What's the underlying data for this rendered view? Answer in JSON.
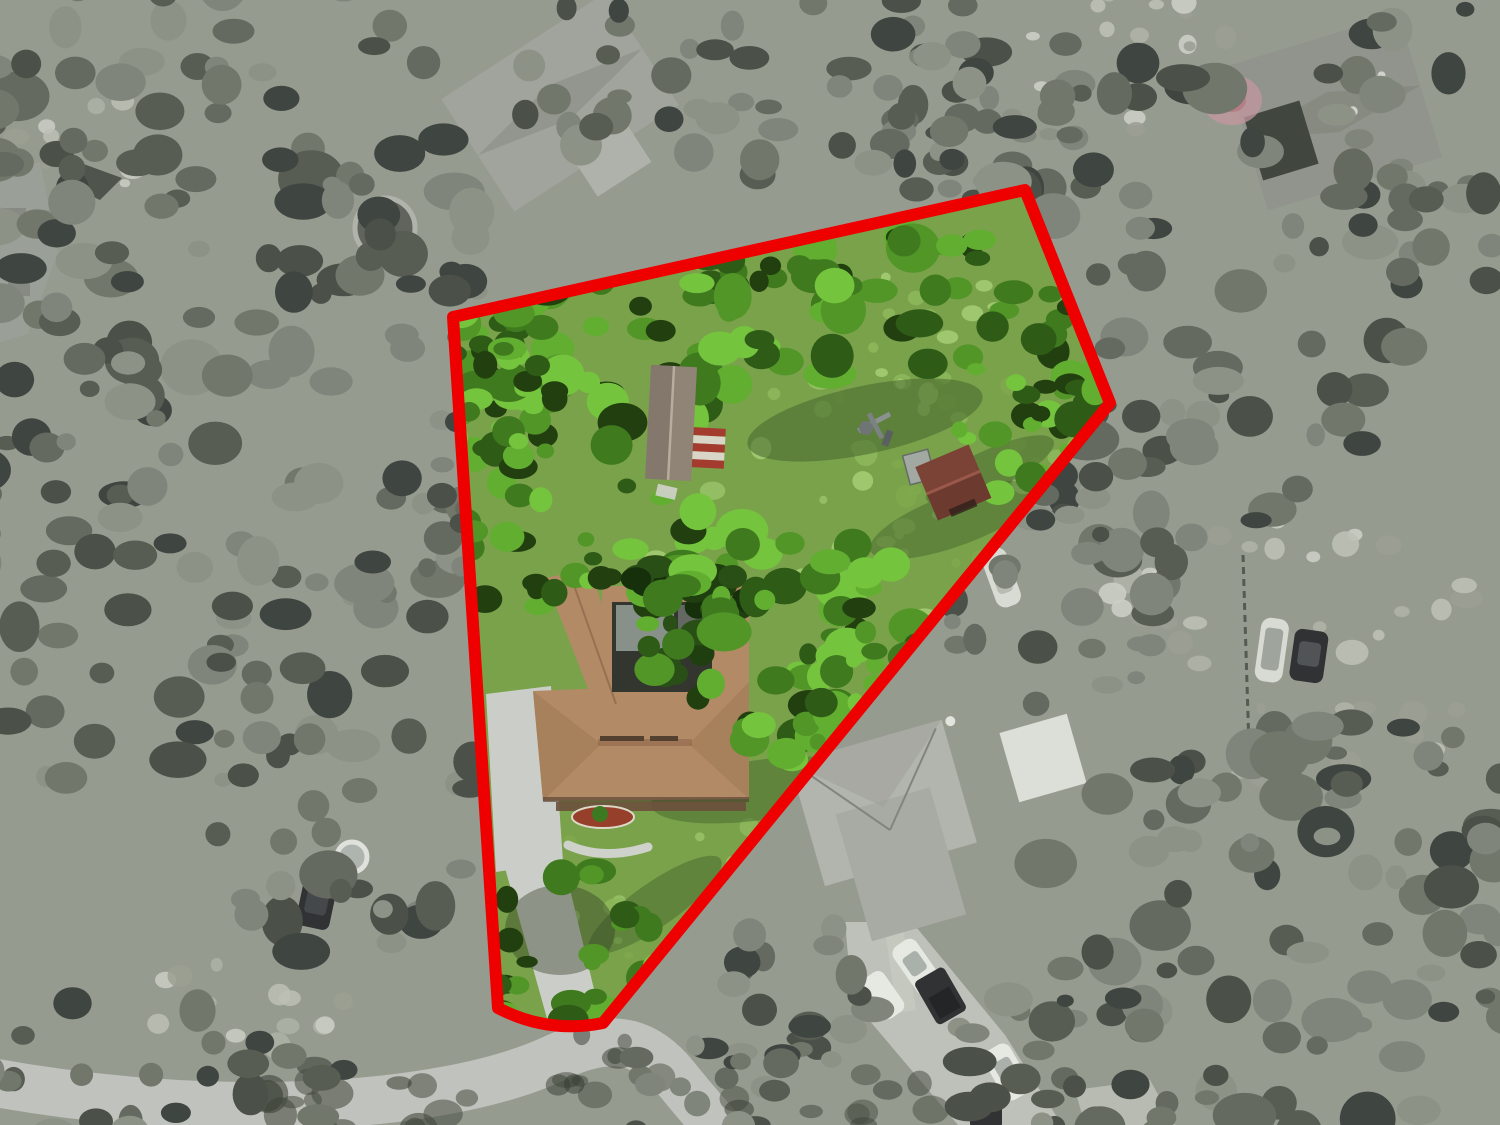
{
  "scene": {
    "type": "aerial-drone-photo",
    "subject": "residential property with red parcel boundary overlay; parcel interior in full color, surroundings desaturated to grayscale"
  },
  "boundary": {
    "path": "M 453 317 L 1025 190 L 1110 403 L 603 1023 Q 548 1034 498 1008 Z",
    "color": "#ef0000",
    "stroke_width": 12
  },
  "colors": {
    "base_gray": "#969b90",
    "lawn": "#7aa24b",
    "road": "#c0c3bd",
    "concrete": "#cbcec8",
    "main_house_roof": "#b38a66",
    "main_house_roof_shade": "#9a744f",
    "screen_enclosure": "#33362f",
    "porch": "#6b4f3c",
    "garden_mulch": "#96402b",
    "shed_roof": "#8f8475",
    "awning_red": "#a33b2e",
    "awning_white": "#d9d5c7",
    "outbuilding_brown": "#7b4336",
    "neighbor_roof_light": "#a0a49c",
    "neighbor_roof_mid": "#90948c",
    "neighbor_roof_br": "#b2b4ae",
    "vehicle_white": "#e6e8e2",
    "vehicle_dark": "#303234",
    "boat_white": "#d8dad4",
    "pool_ring": "#c6cbc5",
    "umbrella_pink": "#c497a0"
  },
  "palettes": {
    "gray_canopy": [
      "#4b5148",
      "#575d53",
      "#646a5f",
      "#71776b",
      "#7f857a",
      "#8d9287",
      "#3f4540"
    ],
    "green_canopy": [
      "#2e5c17",
      "#3f7a1f",
      "#519627",
      "#62ae31",
      "#74c43e",
      "#223f0f"
    ],
    "green_canopy_dark": [
      "#16300c",
      "#1f3f10",
      "#2a4f16"
    ],
    "lawn_light": [
      "#8cb75a",
      "#97c166",
      "#7fa94e",
      "#a3cb72"
    ],
    "field_light": [
      "#aeb3a7",
      "#bcc0b5",
      "#cbcec4",
      "#9ba093"
    ],
    "shadow_olive": [
      "#3e4439",
      "#474d41",
      "#343a30"
    ]
  }
}
